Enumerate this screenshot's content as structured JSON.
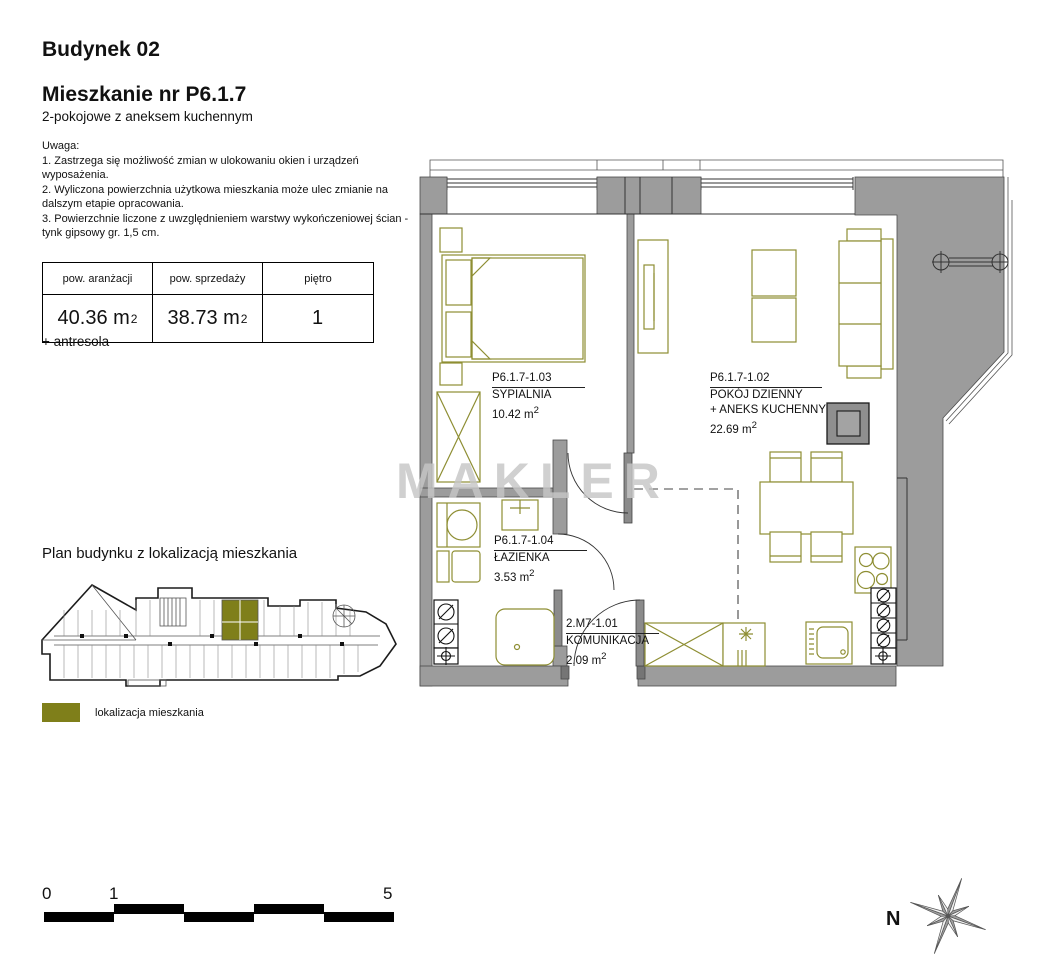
{
  "header": {
    "building": "Budynek 02",
    "apartment_title": "Mieszkanie nr P6.1.7",
    "apartment_subtitle": "2-pokojowe z aneksem kuchennym"
  },
  "notes": {
    "label": "Uwaga:",
    "items": [
      "1. Zastrzega się możliwość zmian w ulokowaniu okien i urządzeń wyposażenia.",
      "2. Wyliczona powierzchnia użytkowa mieszkania może ulec zmianie na dalszym etapie opracowania.",
      "3. Powierzchnie liczone z uwzględnieniem warstwy wykończeniowej ścian - tynk gipsowy gr. 1,5 cm."
    ]
  },
  "area_table": {
    "columns": [
      {
        "header": "pow. aranżacji",
        "value": "40.36 m",
        "sup": "2"
      },
      {
        "header": "pow. sprzedaży",
        "value": "38.73 m",
        "sup": "2"
      },
      {
        "header": "piętro",
        "value": "1",
        "sup": ""
      }
    ]
  },
  "antresola_note": "+ antresola",
  "building_plan": {
    "title": "Plan budynku z lokalizacją mieszkania",
    "legend_label": "lokalizacja mieszkania"
  },
  "floor_plan": {
    "watermark": "MAKLER",
    "rooms": [
      {
        "id": "P6.1.7-1.03",
        "name": "SYPIALNIA",
        "name2": "",
        "area": "10.42 m",
        "area_sup": "2"
      },
      {
        "id": "P6.1.7-1.02",
        "name": "POKÓJ DZIENNY",
        "name2": "+ ANEKS KUCHENNY",
        "area": "22.69 m",
        "area_sup": "2"
      },
      {
        "id": "P6.1.7-1.04",
        "name": "ŁAZIENKA",
        "name2": "",
        "area": "3.53 m",
        "area_sup": "2"
      },
      {
        "id": "2.M7-1.01",
        "name": "KOMUNIKACJA",
        "name2": "",
        "area": "2.09 m",
        "area_sup": "2"
      }
    ]
  },
  "scale_bar": {
    "labels": [
      "0",
      "1",
      "5"
    ]
  },
  "compass": {
    "label": "N"
  },
  "colors": {
    "olive": "#8e8e33",
    "highlight": "#7f7f1a",
    "wall": "#9c9c9c",
    "watermark": "#c6c6c6"
  }
}
